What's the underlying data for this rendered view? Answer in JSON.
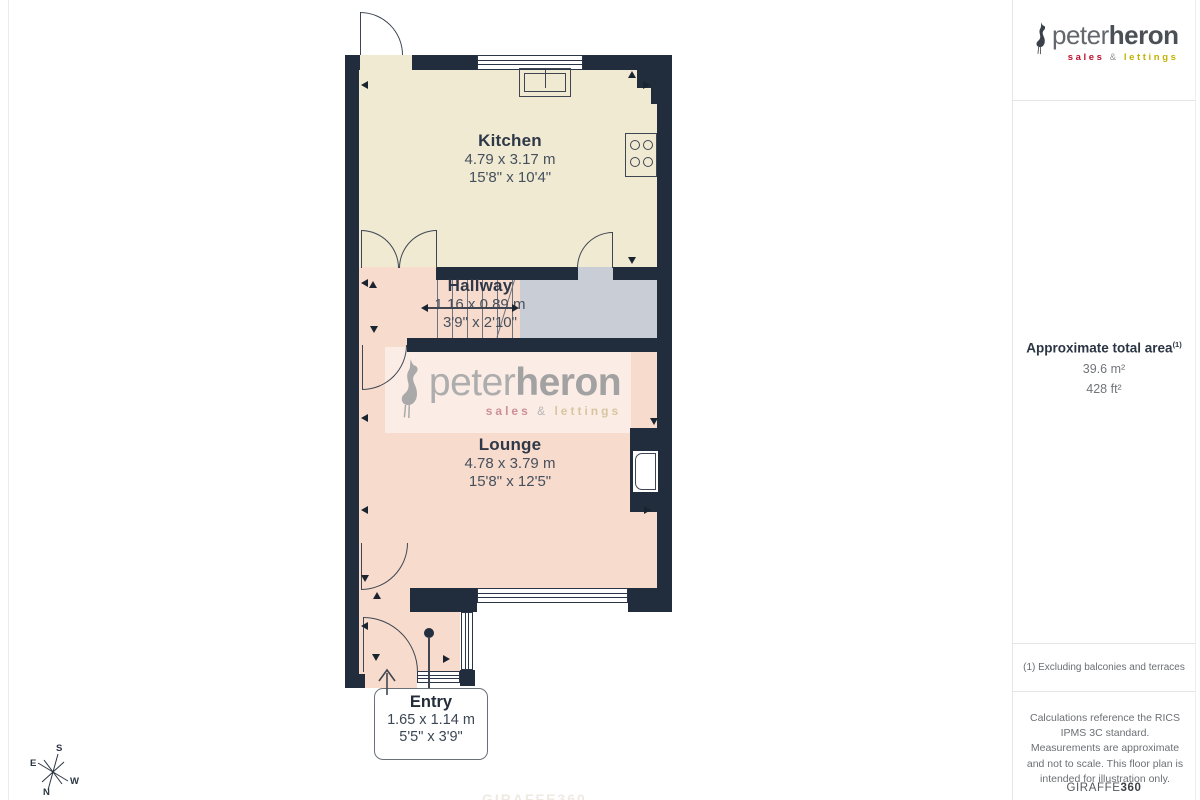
{
  "logo": {
    "peter": "peter",
    "heron": "heron",
    "sales": "sales",
    "amp": "&",
    "lettings": "lettings"
  },
  "sidebar": {
    "area_title": "Approximate total area",
    "area_sup": "(1)",
    "area_m": "39.6 m²",
    "area_ft": "428 ft²",
    "footnote": "(1) Excluding balconies and terraces",
    "disclaimer": "Calculations reference the RICS IPMS 3C standard. Measurements are approximate and not to scale. This floor plan is intended for illustration only.",
    "brand_giraffe": "GIRAFFE",
    "brand_360": "360"
  },
  "floorplan": {
    "rooms": {
      "kitchen": {
        "name": "Kitchen",
        "metric": "4.79 x 3.17 m",
        "imperial": "15'8\" x 10'4\""
      },
      "hallway": {
        "name": "Hallway",
        "metric": "1.16 x 0.89 m",
        "imperial": "3'9\" x 2'10\""
      },
      "lounge": {
        "name": "Lounge",
        "metric": "4.78 x 3.79 m",
        "imperial": "15'8\" x 12'5\""
      },
      "entry": {
        "name": "Entry",
        "metric": "1.65 x 1.14 m",
        "imperial": "5'5\" x 3'9\""
      }
    },
    "compass": {
      "n": "N",
      "s": "S",
      "e": "E",
      "w": "W"
    },
    "watermark_faint": "GIRAFFE360"
  },
  "colors": {
    "wall": "#212d3d",
    "kitchen_floor": "#f0ead2",
    "pink_floor": "#f7dbcc",
    "landing_gray": "#c9cdd6",
    "sales_red": "#c00f2d",
    "lettings_yellow": "#c2b200"
  }
}
